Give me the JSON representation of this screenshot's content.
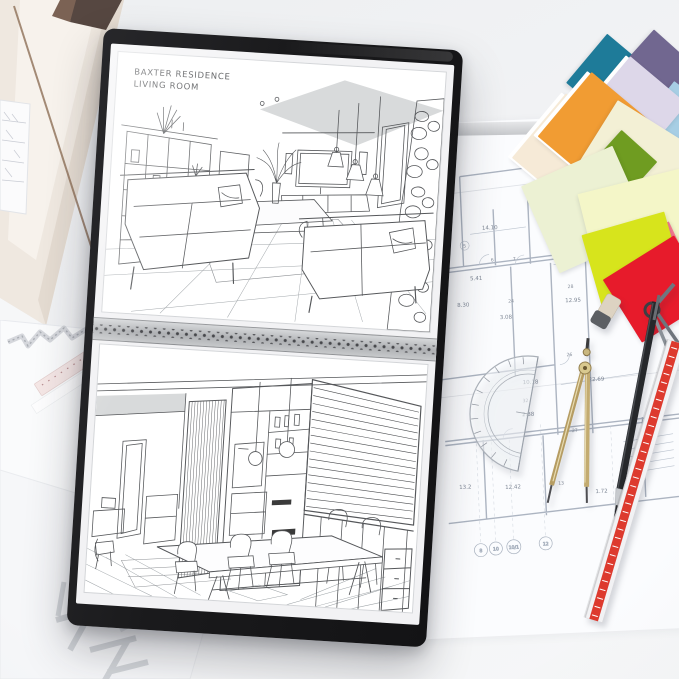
{
  "scene": {
    "description": "Interior designer workspace: black portfolio with two interior perspective sketches lying on architectural blueprints with paint swatches and drafting tools"
  },
  "portfolio": {
    "frame_color": "#1a1a1c",
    "binding_strip_color": "#b0b2b5",
    "top_sketch": {
      "title_line1": "BAXTER RESIDENCE",
      "title_line2": "LIVING ROOM",
      "subject": "living-room-perspective-sketch"
    },
    "bottom_sketch": {
      "subject": "kitchen-dining-perspective-sketch"
    }
  },
  "blueprint": {
    "line_color": "#a9b2bf",
    "label_color": "#7e8795",
    "dims": [
      "14.10",
      "25.17",
      "5.41",
      "8.30",
      "3.08",
      "12.95",
      "10.18",
      "2.88",
      "22.69",
      "12.42",
      "1.72",
      "13.2",
      "3.38"
    ],
    "rooms": [
      "5",
      "6",
      "7",
      "24",
      "28",
      "26",
      "32",
      "27",
      "13"
    ],
    "axis_marks": [
      "8",
      "10",
      "10/1",
      "12",
      "13"
    ],
    "legend": {
      "header": "1",
      "row_label": "2",
      "values": [
        "39.77",
        "88.87",
        "70.98"
      ]
    }
  },
  "swatches": [
    {
      "name": "teal",
      "hex": "#1e7b99"
    },
    {
      "name": "plum-purple",
      "hex": "#716790"
    },
    {
      "name": "sky-blue",
      "hex": "#a7cee4"
    },
    {
      "name": "lavender",
      "hex": "#ddd7e9"
    },
    {
      "name": "cream",
      "hex": "#f6ead7"
    },
    {
      "name": "orange",
      "hex": "#f19c33"
    },
    {
      "name": "pale-yellow",
      "hex": "#f3f0d5"
    },
    {
      "name": "leaf-green",
      "hex": "#6f9c21"
    },
    {
      "name": "pale-green",
      "hex": "#ecf1d3"
    },
    {
      "name": "lemon",
      "hex": "#f4f6c8"
    },
    {
      "name": "yellow",
      "hex": "#fedf00"
    },
    {
      "name": "coral-pink",
      "hex": "#f4798f"
    },
    {
      "name": "magenta",
      "hex": "#e73563"
    },
    {
      "name": "chartreuse",
      "hex": "#d7e41c"
    },
    {
      "name": "red",
      "hex": "#e71b2b"
    }
  ],
  "tools": {
    "scale_ruler_stripe": "#dd3a2e",
    "compass_brass": "#b59c62",
    "pencil_body": "#26282b",
    "protractor_edge": "#aab0b8"
  }
}
